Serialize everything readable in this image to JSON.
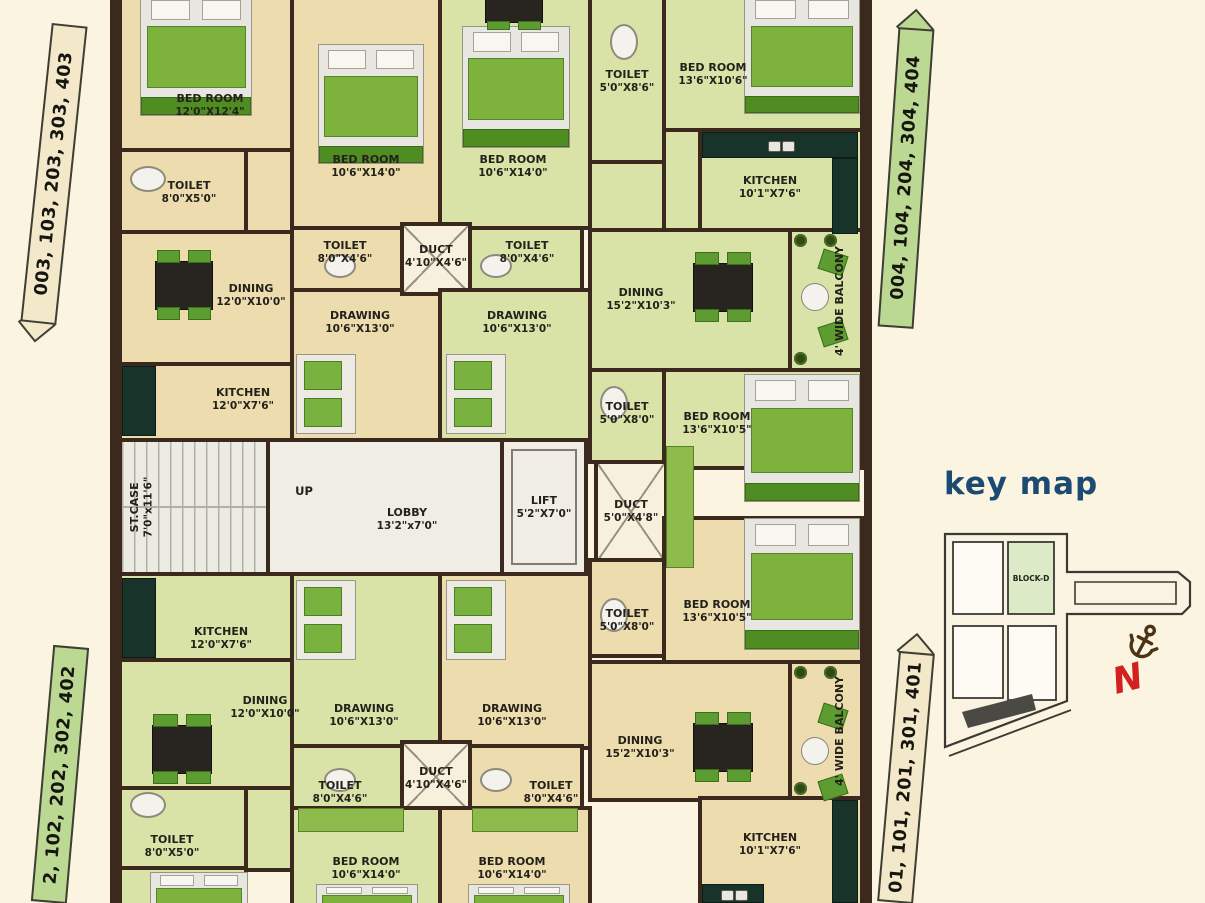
{
  "palette": {
    "background": "#fbf4e1",
    "wall": "#3a291c",
    "room_beige": "#ecdcae",
    "room_green": "#d9e3a8",
    "furniture_green": "#5d9c30",
    "label_box_beige": "#f3e9ca",
    "label_box_green": "#bcd994",
    "keymap_blue": "#1d4a73",
    "north_red": "#d32020",
    "anchor_brown": "#4b3416"
  },
  "unit_labels": [
    {
      "text": "003, 103, 203, 303, 403",
      "x": 36,
      "y": 24,
      "w": 36,
      "h": 300,
      "style": "beige",
      "arrow": "down",
      "tilt": 6
    },
    {
      "text": "004, 104, 204, 304, 404",
      "x": 888,
      "y": 28,
      "w": 36,
      "h": 300,
      "style": "green",
      "arrow": "up",
      "tilt": 4
    },
    {
      "text": "2, 102, 202, 302, 402",
      "x": 42,
      "y": 646,
      "w": 36,
      "h": 257,
      "style": "green",
      "arrow": "none",
      "tilt": 5
    },
    {
      "text": "01, 101, 201, 301, 401",
      "x": 888,
      "y": 652,
      "w": 36,
      "h": 251,
      "style": "beige",
      "arrow": "up",
      "tilt": 5
    }
  ],
  "rooms": [
    {
      "name": "BED ROOM",
      "dims": "12'0\"X12'4\"",
      "x": 118,
      "y": -6,
      "w": 176,
      "h": 158,
      "fill": "beige",
      "lx": 210,
      "ly": 106
    },
    {
      "name": "TOILET",
      "dims": "8'0\"X5'0\"",
      "x": 118,
      "y": 148,
      "w": 130,
      "h": 86,
      "fill": "beige",
      "lx": 189,
      "ly": 193
    },
    {
      "name": "",
      "x": 244,
      "y": 148,
      "w": 50,
      "h": 86,
      "fill": "beige"
    },
    {
      "name": "BED ROOM",
      "dims": "10'6\"X14'0\"",
      "x": 290,
      "y": -6,
      "w": 152,
      "h": 236,
      "fill": "beige",
      "lx": 366,
      "ly": 167
    },
    {
      "name": "DINING",
      "dims": "12'0\"X10'0\"",
      "x": 118,
      "y": 230,
      "w": 176,
      "h": 136,
      "fill": "beige",
      "lx": 251,
      "ly": 296
    },
    {
      "name": "KITCHEN",
      "dims": "12'0\"X7'6\"",
      "x": 118,
      "y": 362,
      "w": 176,
      "h": 80,
      "fill": "beige",
      "lx": 243,
      "ly": 400
    },
    {
      "name": "TOILET",
      "dims": "8'0\"X4'6\"",
      "x": 290,
      "y": 226,
      "w": 116,
      "h": 66,
      "fill": "beige",
      "lx": 345,
      "ly": 253
    },
    {
      "name": "DRAWING",
      "dims": "10'6\"X13'0\"",
      "x": 290,
      "y": 288,
      "w": 152,
      "h": 154,
      "fill": "beige",
      "lx": 360,
      "ly": 323
    },
    {
      "name": "BED ROOM",
      "dims": "10'6\"X14'0\"",
      "x": 438,
      "y": -6,
      "w": 154,
      "h": 236,
      "fill": "green",
      "lx": 513,
      "ly": 167
    },
    {
      "name": "TOILET",
      "dims": "5'0\"X8'6\"",
      "x": 588,
      "y": -6,
      "w": 78,
      "h": 170,
      "fill": "green",
      "lx": 627,
      "ly": 82
    },
    {
      "name": "BED ROOM",
      "dims": "13'6\"X10'6\"",
      "x": 662,
      "y": -6,
      "w": 202,
      "h": 138,
      "fill": "green",
      "lx": 713,
      "ly": 75
    },
    {
      "name": "KITCHEN",
      "dims": "10'1\"X7'6\"",
      "x": 698,
      "y": 128,
      "w": 166,
      "h": 110,
      "fill": "green",
      "lx": 770,
      "ly": 188
    },
    {
      "name": "",
      "x": 588,
      "y": 160,
      "w": 78,
      "h": 74,
      "fill": "green"
    },
    {
      "name": "",
      "x": 662,
      "y": 128,
      "w": 40,
      "h": 110,
      "fill": "green"
    },
    {
      "name": "TOILET",
      "dims": "8'0\"X4'6\"",
      "x": 468,
      "y": 226,
      "w": 116,
      "h": 66,
      "fill": "green",
      "lx": 527,
      "ly": 253
    },
    {
      "name": "DUCT",
      "dims": "4'10\"X4'6\"",
      "x": 400,
      "y": 222,
      "w": 72,
      "h": 74,
      "fill": "duct",
      "cross": true,
      "lx": 436,
      "ly": 257
    },
    {
      "name": "DRAWING",
      "dims": "10'6\"X13'0\"",
      "x": 438,
      "y": 288,
      "w": 154,
      "h": 154,
      "fill": "green",
      "lx": 517,
      "ly": 323
    },
    {
      "name": "DINING",
      "dims": "15'2\"X10'3\"",
      "x": 588,
      "y": 228,
      "w": 204,
      "h": 146,
      "fill": "green",
      "lx": 641,
      "ly": 300
    },
    {
      "name": "4' WIDE BALCONY",
      "x": 788,
      "y": 228,
      "w": 76,
      "h": 146,
      "fill": "green",
      "lx": 840,
      "ly": 301,
      "v": true
    },
    {
      "name": "TOILET",
      "dims": "5'0\"X8'0\"",
      "x": 588,
      "y": 368,
      "w": 78,
      "h": 96,
      "fill": "green",
      "lx": 627,
      "ly": 414
    },
    {
      "name": "BED ROOM",
      "dims": "13'6\"X10'5\"",
      "x": 662,
      "y": 368,
      "w": 202,
      "h": 102,
      "fill": "green",
      "lx": 717,
      "ly": 424
    },
    {
      "name": "ST.CASE",
      "dims": "7'0\"x11'6\"",
      "x": 118,
      "y": 438,
      "w": 152,
      "h": 138,
      "fill": "stair",
      "lx": 142,
      "ly": 507,
      "v": true
    },
    {
      "name": "LOBBY",
      "dims": "13'2\"x7'0\"",
      "x": 266,
      "y": 438,
      "w": 238,
      "h": 138,
      "fill": "white",
      "lx": 407,
      "ly": 520
    },
    {
      "name": "LIFT",
      "dims": "5'2\"X7'0\"",
      "x": 500,
      "y": 438,
      "w": 88,
      "h": 138,
      "fill": "lift",
      "lx": 544,
      "ly": 508
    },
    {
      "name": "DUCT",
      "dims": "5'0\"X4'8\"",
      "x": 594,
      "y": 460,
      "w": 74,
      "h": 104,
      "fill": "duct",
      "cross": true,
      "lx": 631,
      "ly": 512
    },
    {
      "name": "TOILET",
      "dims": "5'0\"X8'0\"",
      "x": 588,
      "y": 558,
      "w": 78,
      "h": 100,
      "fill": "beige",
      "lx": 627,
      "ly": 621
    },
    {
      "name": "BED ROOM",
      "dims": "13'6\"X10'5\"",
      "x": 662,
      "y": 516,
      "w": 202,
      "h": 150,
      "fill": "beige",
      "lx": 717,
      "ly": 612
    },
    {
      "name": "KITCHEN",
      "dims": "12'0\"X7'6\"",
      "x": 118,
      "y": 572,
      "w": 176,
      "h": 90,
      "fill": "green",
      "lx": 221,
      "ly": 639
    },
    {
      "name": "DINING",
      "dims": "12'0\"X10'0\"",
      "x": 118,
      "y": 658,
      "w": 176,
      "h": 134,
      "fill": "green",
      "lx": 265,
      "ly": 708
    },
    {
      "name": "DRAWING",
      "dims": "10'6\"X13'0\"",
      "x": 290,
      "y": 572,
      "w": 152,
      "h": 178,
      "fill": "green",
      "lx": 364,
      "ly": 716
    },
    {
      "name": "DRAWING",
      "dims": "10'6\"X13'0\"",
      "x": 438,
      "y": 572,
      "w": 154,
      "h": 178,
      "fill": "beige",
      "lx": 512,
      "ly": 716
    },
    {
      "name": "DINING",
      "dims": "15'2\"X10'3\"",
      "x": 588,
      "y": 660,
      "w": 204,
      "h": 142,
      "fill": "beige",
      "lx": 640,
      "ly": 748
    },
    {
      "name": "4' WIDE BALCONY",
      "x": 788,
      "y": 660,
      "w": 76,
      "h": 142,
      "fill": "beige",
      "lx": 840,
      "ly": 731,
      "v": true
    },
    {
      "name": "TOILET",
      "dims": "8'0\"X4'6\"",
      "x": 290,
      "y": 744,
      "w": 116,
      "h": 66,
      "fill": "green",
      "lx": 340,
      "ly": 793
    },
    {
      "name": "DUCT",
      "dims": "4'10\"X4'6\"",
      "x": 400,
      "y": 740,
      "w": 72,
      "h": 74,
      "fill": "duct",
      "cross": true,
      "lx": 436,
      "ly": 779
    },
    {
      "name": "TOILET",
      "dims": "8'0\"X4'6\"",
      "x": 468,
      "y": 744,
      "w": 116,
      "h": 66,
      "fill": "beige",
      "lx": 551,
      "ly": 793
    },
    {
      "name": "TOILET",
      "dims": "8'0\"X5'0\"",
      "x": 118,
      "y": 786,
      "w": 130,
      "h": 86,
      "fill": "green",
      "lx": 172,
      "ly": 847
    },
    {
      "name": "",
      "x": 244,
      "y": 786,
      "w": 50,
      "h": 86,
      "fill": "green"
    },
    {
      "name": "BED ROOM",
      "dims": "10'6\"X14'0\"",
      "x": 290,
      "y": 806,
      "w": 152,
      "h": 103,
      "fill": "green",
      "lx": 366,
      "ly": 869
    },
    {
      "name": "BED ROOM",
      "dims": "10'6\"X14'0\"",
      "x": 438,
      "y": 806,
      "w": 154,
      "h": 103,
      "fill": "beige",
      "lx": 512,
      "ly": 869
    },
    {
      "name": "KITCHEN",
      "dims": "10'1\"X7'6\"",
      "x": 698,
      "y": 796,
      "w": 166,
      "h": 113,
      "fill": "beige",
      "lx": 770,
      "ly": 845
    },
    {
      "name": "",
      "x": 118,
      "y": 866,
      "w": 130,
      "h": 43,
      "fill": "green"
    }
  ],
  "texts": [
    {
      "text": "UP",
      "x": 304,
      "y": 491
    }
  ],
  "furniture": [
    {
      "t": "bed",
      "x": 140,
      "y": -6,
      "w": 112,
      "h": 122
    },
    {
      "t": "bed",
      "x": 318,
      "y": 44,
      "w": 106,
      "h": 120
    },
    {
      "t": "bed",
      "x": 462,
      "y": 26,
      "w": 108,
      "h": 122
    },
    {
      "t": "bed",
      "x": 744,
      "y": -6,
      "w": 116,
      "h": 120
    },
    {
      "t": "bed",
      "x": 744,
      "y": 374,
      "w": 116,
      "h": 128
    },
    {
      "t": "bed",
      "x": 744,
      "y": 518,
      "w": 116,
      "h": 132
    },
    {
      "t": "bed",
      "x": 150,
      "y": 872,
      "w": 98,
      "h": 60
    },
    {
      "t": "bed",
      "x": 316,
      "y": 884,
      "w": 102,
      "h": 40
    },
    {
      "t": "bed",
      "x": 468,
      "y": 884,
      "w": 102,
      "h": 40
    },
    {
      "t": "table",
      "x": 148,
      "y": 250,
      "w": 72,
      "h": 70
    },
    {
      "t": "table",
      "x": 686,
      "y": 252,
      "w": 74,
      "h": 70
    },
    {
      "t": "table",
      "x": 144,
      "y": 714,
      "w": 76,
      "h": 70
    },
    {
      "t": "table",
      "x": 686,
      "y": 712,
      "w": 74,
      "h": 70
    },
    {
      "t": "table",
      "x": 478,
      "y": -16,
      "w": 72,
      "h": 46
    },
    {
      "t": "counter",
      "x": 122,
      "y": 366,
      "w": 34,
      "h": 70
    },
    {
      "t": "counter",
      "x": 702,
      "y": 132,
      "w": 156,
      "h": 26
    },
    {
      "t": "counter",
      "x": 832,
      "y": 158,
      "w": 26,
      "h": 76
    },
    {
      "t": "counter",
      "x": 122,
      "y": 578,
      "w": 34,
      "h": 80
    },
    {
      "t": "counter",
      "x": 832,
      "y": 800,
      "w": 26,
      "h": 103
    },
    {
      "t": "counter",
      "x": 702,
      "y": 884,
      "w": 62,
      "h": 19
    },
    {
      "t": "wc",
      "x": 130,
      "y": 166,
      "w": 36,
      "h": 26
    },
    {
      "t": "wc",
      "x": 324,
      "y": 254,
      "w": 32,
      "h": 24
    },
    {
      "t": "wc",
      "x": 610,
      "y": 24,
      "w": 28,
      "h": 36
    },
    {
      "t": "wc",
      "x": 480,
      "y": 254,
      "w": 32,
      "h": 24
    },
    {
      "t": "wc",
      "x": 600,
      "y": 386,
      "w": 28,
      "h": 34
    },
    {
      "t": "wc",
      "x": 600,
      "y": 598,
      "w": 28,
      "h": 34
    },
    {
      "t": "wc",
      "x": 480,
      "y": 768,
      "w": 32,
      "h": 24
    },
    {
      "t": "wc",
      "x": 324,
      "y": 768,
      "w": 32,
      "h": 24
    },
    {
      "t": "wc",
      "x": 130,
      "y": 792,
      "w": 36,
      "h": 26
    },
    {
      "t": "sofa",
      "x": 296,
      "y": 354,
      "w": 60,
      "h": 80
    },
    {
      "t": "sofa",
      "x": 446,
      "y": 354,
      "w": 60,
      "h": 80
    },
    {
      "t": "sofa",
      "x": 296,
      "y": 580,
      "w": 60,
      "h": 80
    },
    {
      "t": "sofa",
      "x": 446,
      "y": 580,
      "w": 60,
      "h": 80
    },
    {
      "t": "bset",
      "x": 796,
      "y": 252,
      "w": 60,
      "h": 92
    },
    {
      "t": "bset",
      "x": 796,
      "y": 706,
      "w": 60,
      "h": 92
    },
    {
      "t": "plant",
      "x": 794,
      "y": 234
    },
    {
      "t": "plant",
      "x": 824,
      "y": 234
    },
    {
      "t": "plant",
      "x": 794,
      "y": 352
    },
    {
      "t": "plant",
      "x": 794,
      "y": 666
    },
    {
      "t": "plant",
      "x": 824,
      "y": 666
    },
    {
      "t": "plant",
      "x": 794,
      "y": 782
    },
    {
      "t": "ward",
      "x": 666,
      "y": 446,
      "w": 28,
      "h": 122
    },
    {
      "t": "ward",
      "x": 298,
      "y": 808,
      "w": 106,
      "h": 24
    },
    {
      "t": "ward",
      "x": 472,
      "y": 808,
      "w": 106,
      "h": 24
    }
  ],
  "key_map": {
    "title": "key map",
    "block_label": "BLOCK-D",
    "north": "N",
    "anchor_icon": "anchor-icon",
    "north_icon": "north-arrow-icon"
  }
}
